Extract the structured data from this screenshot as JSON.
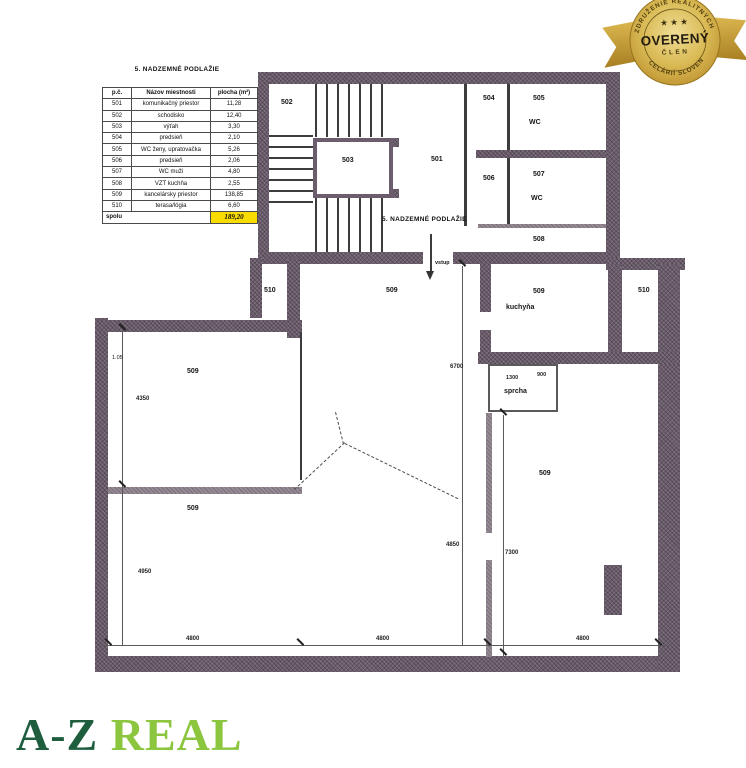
{
  "badge": {
    "arc_top": "ZDRUŽENIE REALITNÝCH",
    "arc_bottom": "KANCELÁRIÍ SLOVENSKA",
    "title": "OVERENÝ",
    "subtitle": "ČLEN",
    "stars": "★ ★ ★",
    "gold_color": "#d2a93f"
  },
  "logo": {
    "part1": "A-Z",
    "part2": "REAL",
    "color_primary": "#1e5e3e",
    "color_secondary": "#8cc63f"
  },
  "schedule": {
    "title": "5. NADZEMNÉ PODLAŽIE",
    "headers": [
      "p.č.",
      "Názov miestnosti",
      "plocha (m²)"
    ],
    "rows": [
      [
        "501",
        "komunikačný priestor",
        "11,28"
      ],
      [
        "502",
        "schodisko",
        "12,40"
      ],
      [
        "503",
        "výťah",
        "3,30"
      ],
      [
        "504",
        "predsieň",
        "2,10"
      ],
      [
        "505",
        "WC ženy, upratovačka",
        "5,26"
      ],
      [
        "506",
        "predsieň",
        "2,06"
      ],
      [
        "507",
        "WC muži",
        "4,80"
      ],
      [
        "508",
        "VZT kuchňa",
        "2,55"
      ],
      [
        "509",
        "kancelársky priestor",
        "138,85"
      ],
      [
        "510",
        "terasa/lógia",
        "6,60"
      ]
    ],
    "total_label": "spolu",
    "total_value": "189,20",
    "highlight_color": "#f8dc00"
  },
  "plan": {
    "floor_label": "5. NADZEMNÉ PODLAŽIE",
    "labels": {
      "n501": "501",
      "n502": "502",
      "n503": "503",
      "n504": "504",
      "n505": "505",
      "n506": "506",
      "n507": "507",
      "n508": "508",
      "n509": "509",
      "n510": "510",
      "wc": "WC",
      "kitchen": "kuchyňa",
      "shower": "sprcha",
      "entrance": "vstup",
      "note": "1.05"
    },
    "dimensions": {
      "d4350": "4350",
      "d4950": "4950",
      "d6700": "6700",
      "d4850": "4850",
      "d7300": "7300",
      "d4800": "4800",
      "d1300": "1300",
      "d900": "900"
    }
  }
}
